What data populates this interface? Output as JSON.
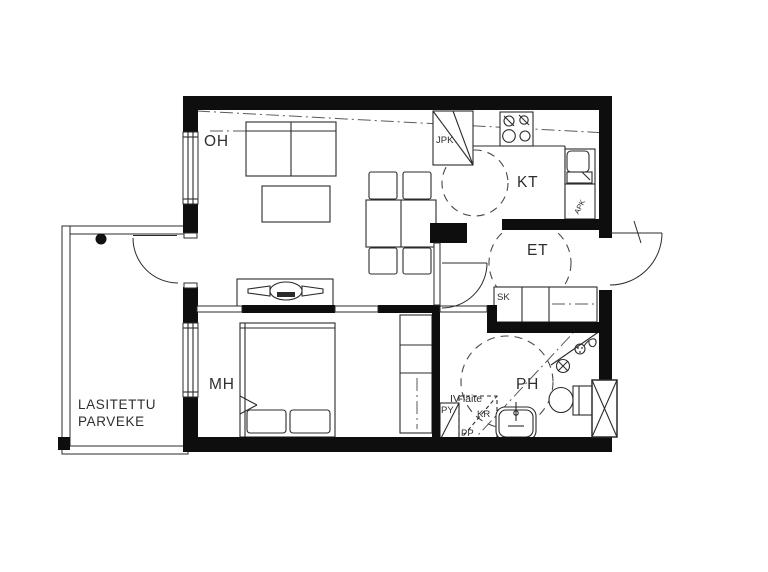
{
  "canvas": {
    "background": "#ffffff",
    "line_color": "#0e0e0e"
  },
  "rooms": {
    "living": {
      "label": "OH"
    },
    "kitchen": {
      "label": "KT"
    },
    "entry": {
      "label": "ET"
    },
    "bedroom": {
      "label": "MH"
    },
    "bathroom": {
      "label": "PH"
    },
    "balcony": {
      "label_line1": "LASITETTU",
      "label_line2": "PARVEKE"
    }
  },
  "appliances": {
    "fridge_freezer": "JPK",
    "dishwasher": "APK",
    "cleaning_closet": "SK",
    "washing_machine": "PY",
    "dryer_reserve": "KR",
    "washer_reserve": "PP",
    "ventilation_unit": "IV-laite"
  }
}
